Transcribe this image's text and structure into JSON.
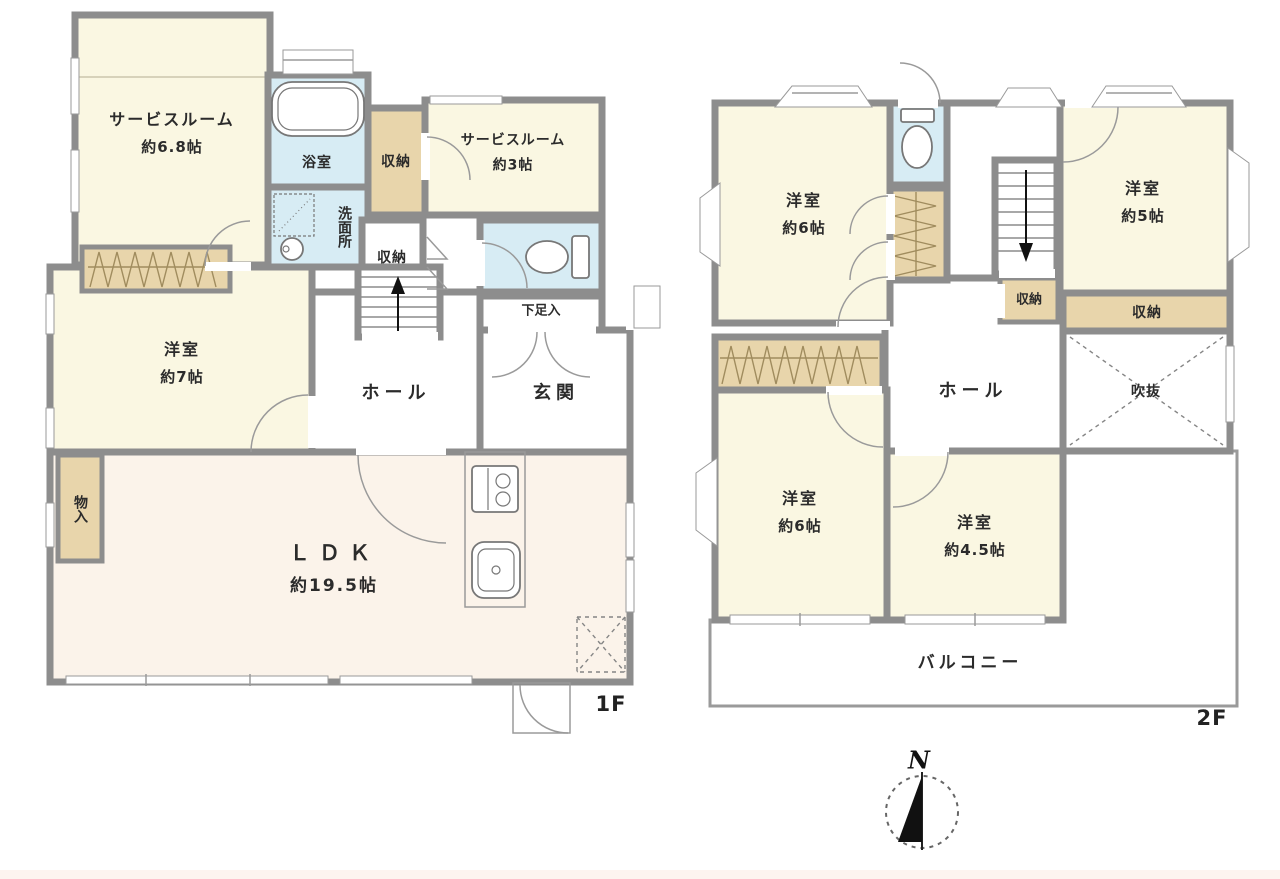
{
  "colors": {
    "wall": "#8d8d8d",
    "cream": "#faf7e2",
    "ldk": "#fbf3ea",
    "water": "#d7ecf4",
    "tan": "#e8d5ab",
    "line": "#9a9a9a",
    "zigzag": "#a08c5e",
    "text": "#2b2b2b",
    "strip": "#fdf4ef"
  },
  "floors": {
    "f1": {
      "label": "1F",
      "rooms": {
        "service68": {
          "name": "サービスルーム",
          "size": "約6.8帖"
        },
        "bath": {
          "name": "浴室"
        },
        "wash": {
          "name": "洗面所"
        },
        "storage_a": {
          "name": "収納"
        },
        "service3": {
          "name": "サービスルーム",
          "size": "約3帖"
        },
        "storage_b": {
          "name": "収納"
        },
        "shoe": {
          "name": "下足入"
        },
        "hall": {
          "name": "ホール"
        },
        "entrance": {
          "name": "玄関"
        },
        "west7": {
          "name": "洋室",
          "size": "約7帖"
        },
        "mono": {
          "name": "物入"
        },
        "ldk": {
          "name": "ＬＤＫ",
          "size": "約19.5帖"
        }
      }
    },
    "f2": {
      "label": "2F",
      "rooms": {
        "west6a": {
          "name": "洋室",
          "size": "約6帖"
        },
        "west5": {
          "name": "洋室",
          "size": "約5帖"
        },
        "storage_c": {
          "name": "収納"
        },
        "storage_d": {
          "name": "収納"
        },
        "void": {
          "name": "吹抜"
        },
        "hall": {
          "name": "ホール"
        },
        "west6b": {
          "name": "洋室",
          "size": "約6帖"
        },
        "west45": {
          "name": "洋室",
          "size": "約4.5帖"
        },
        "balcony": {
          "name": "バルコニー"
        }
      }
    }
  },
  "compass": {
    "label": "N"
  }
}
